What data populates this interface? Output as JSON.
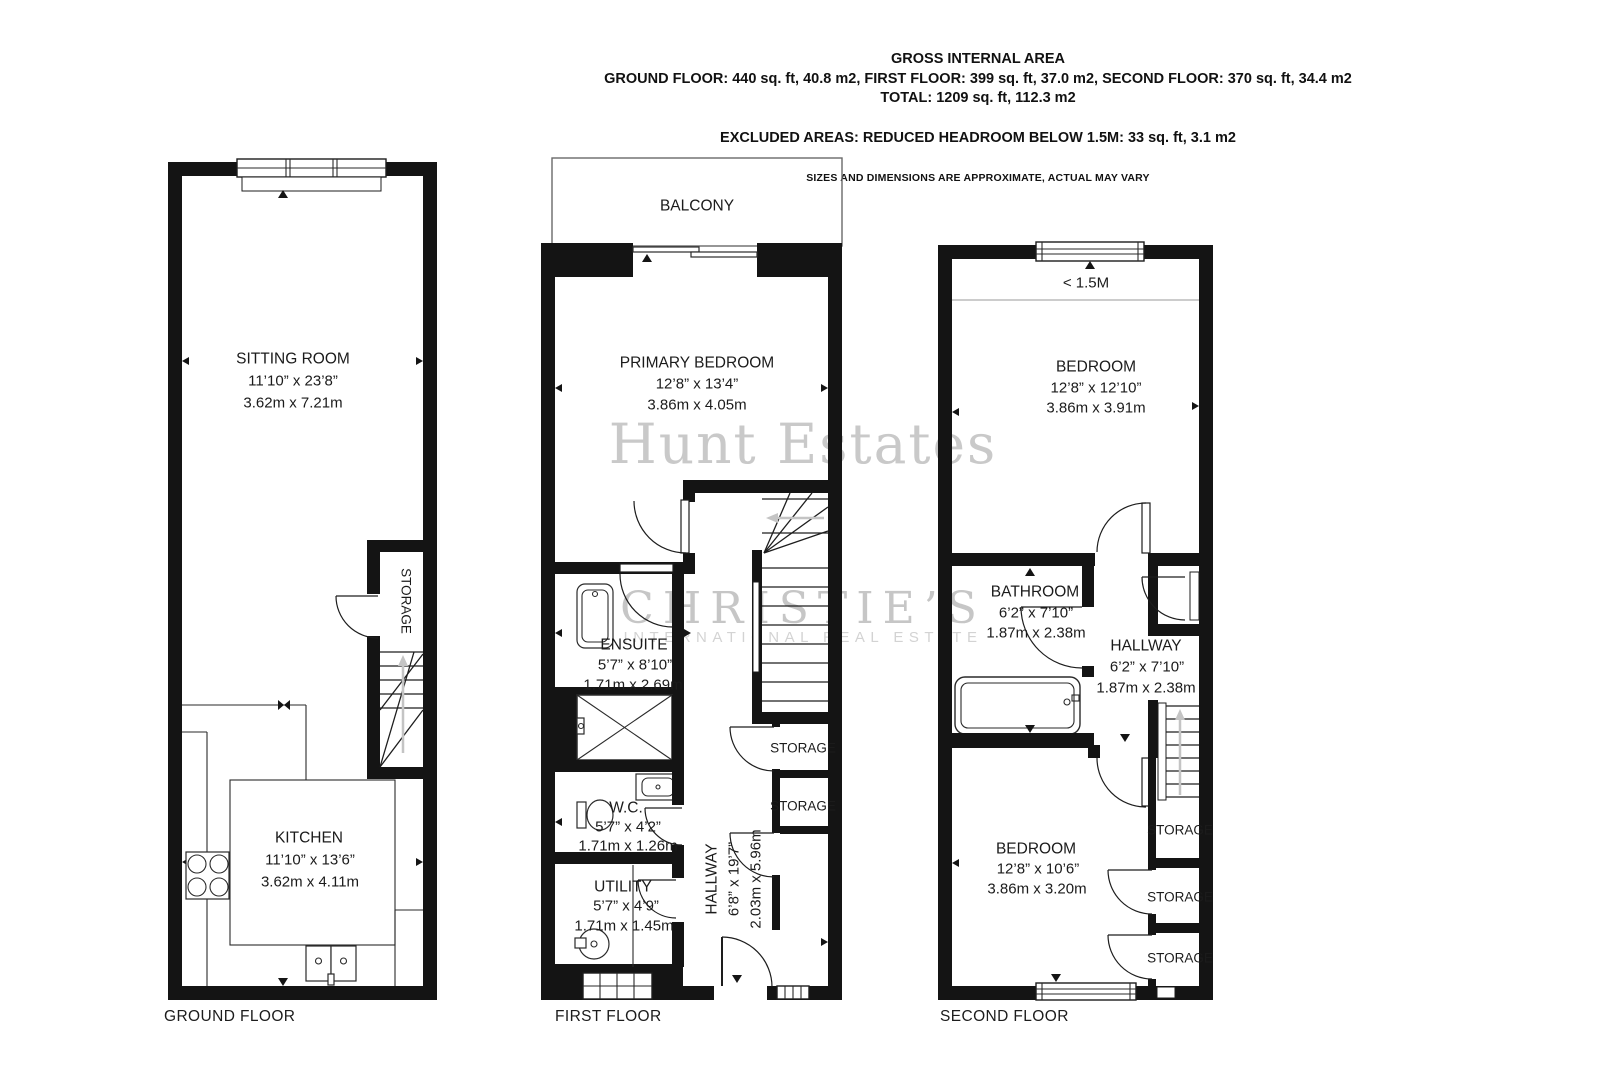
{
  "header": {
    "title": "GROSS INTERNAL AREA",
    "areas": "GROUND FLOOR: 440 sq. ft, 40.8 m2, FIRST FLOOR: 399 sq. ft, 37.0 m2, SECOND FLOOR: 370 sq. ft, 34.4 m2",
    "total": "TOTAL: 1209 sq. ft, 112.3 m2",
    "excluded": "EXCLUDED AREAS: REDUCED HEADROOM BELOW 1.5M: 33 sq. ft, 3.1 m2",
    "disclaimer": "SIZES AND DIMENSIONS ARE APPROXIMATE, ACTUAL MAY VARY"
  },
  "watermark": {
    "name": "Hunt Estates",
    "brand": "CHRISTIE’S",
    "brand_sub": "INTERNATIONAL REAL ESTATE"
  },
  "floors": {
    "ground": {
      "label": "GROUND FLOOR",
      "sitting_room": {
        "name": "SITTING ROOM",
        "imperial": "11’10” x 23’8”",
        "metric": "3.62m x 7.21m"
      },
      "kitchen": {
        "name": "KITCHEN",
        "imperial": "11’10” x 13’6”",
        "metric": "3.62m x 4.11m"
      },
      "storage": {
        "name": "STORAGE"
      }
    },
    "first": {
      "label": "FIRST FLOOR",
      "balcony": {
        "name": "BALCONY"
      },
      "primary_bedroom": {
        "name": "PRIMARY BEDROOM",
        "imperial": "12’8” x 13’4”",
        "metric": "3.86m x 4.05m"
      },
      "ensuite": {
        "name": "ENSUITE",
        "imperial": "5’7” x 8’10”",
        "metric": "1.71m x 2.69m"
      },
      "wc": {
        "name": "W.C.",
        "imperial": "5’7” x 4’2”",
        "metric": "1.71m x 1.26m"
      },
      "utility": {
        "name": "UTILITY",
        "imperial": "5’7” x 4’9”",
        "metric": "1.71m x 1.45m"
      },
      "hallway": {
        "name": "HALLWAY",
        "imperial": "6’8” x 19’7”",
        "metric": "2.03m x 5.96m"
      },
      "storage_upper": {
        "name": "STORAGE"
      },
      "storage_lower": {
        "name": "STORAGE"
      }
    },
    "second": {
      "label": "SECOND FLOOR",
      "headroom_note": "< 1.5M",
      "bedroom_rear": {
        "name": "BEDROOM",
        "imperial": "12’8” x 12’10”",
        "metric": "3.86m x 3.91m"
      },
      "bathroom": {
        "name": "BATHROOM",
        "imperial": "6’2” x 7’10”",
        "metric": "1.87m x 2.38m"
      },
      "hallway": {
        "name": "HALLWAY",
        "imperial": "6’2” x 7’10”",
        "metric": "1.87m x 2.38m"
      },
      "bedroom_front": {
        "name": "BEDROOM",
        "imperial": "12’8” x 10’6”",
        "metric": "3.86m x 3.20m"
      },
      "storage_1": {
        "name": "STORAGE"
      },
      "storage_2": {
        "name": "STORAGE"
      },
      "storage_3": {
        "name": "STORAGE"
      }
    }
  }
}
